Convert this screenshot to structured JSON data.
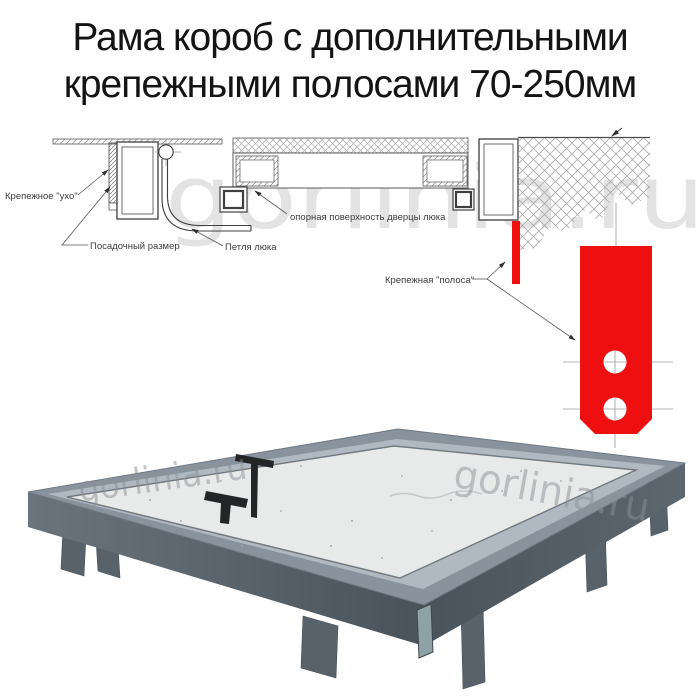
{
  "title": {
    "line1": "Рама короб с дополнительными",
    "line2": "крепежными полосами 70-250мм"
  },
  "watermark": "gorlinia.ru",
  "diagram": {
    "labels": {
      "ear": "Крепежное \"ухо\"",
      "seat_size": "Посадочный размер",
      "hinge": "Петля люка",
      "support": "опорная поверхность дверцы люка",
      "strip": "Крепежная \"полоса\""
    },
    "colors": {
      "strip_red": "#ee1010",
      "line": "#3f3f3f",
      "hatch": "#a0a0a0"
    }
  },
  "photo": {
    "colors": {
      "frame_top": "#89939d",
      "frame_front": "#57616a",
      "rim": "#b0b9c1",
      "panel": "#e8eae9",
      "leg": "#58626b",
      "handle": "#232527"
    }
  }
}
